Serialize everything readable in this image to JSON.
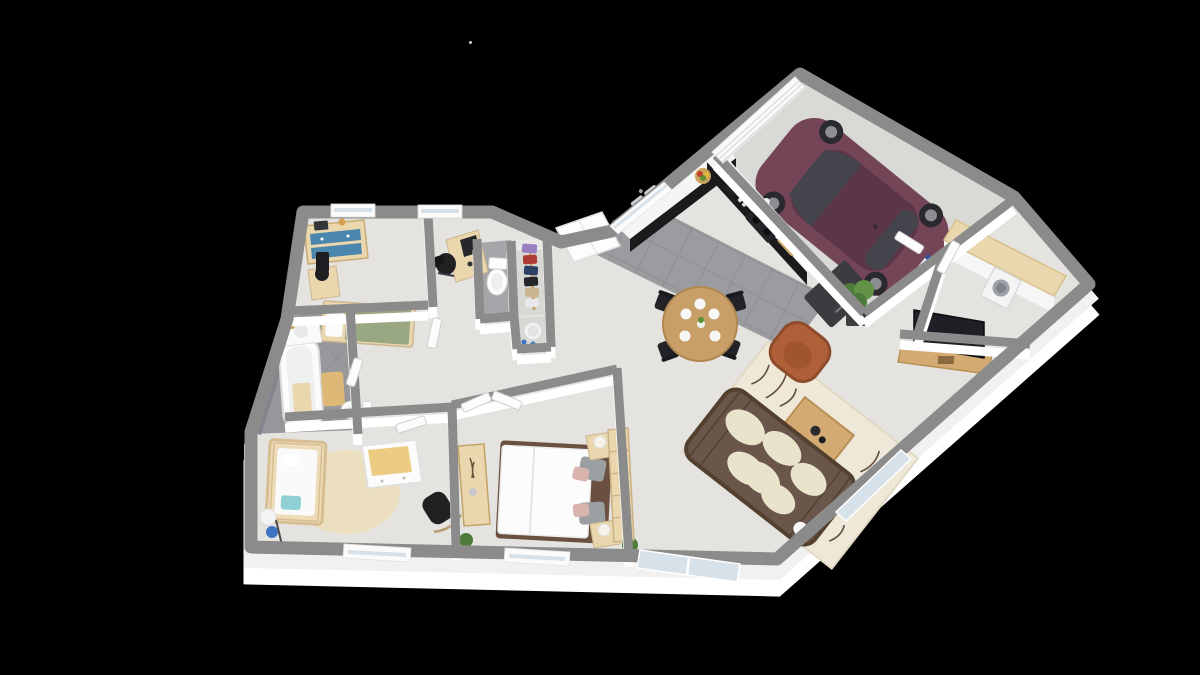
{
  "canvas": {
    "width": 1200,
    "height": 675
  },
  "scene": {
    "description": "Isometric 3D rendered floor plan of a single-storey house with integral garage, shown on a plain black background. No text, toolbars or UI chrome are visible.",
    "view": "top-down isometric render, day wing rotated about 40 degrees versus night wing",
    "artifact_dot": {
      "x": 470,
      "y": 42
    }
  },
  "palette": {
    "bg": "#000000",
    "wall_top": "#8b8b8b",
    "wall_face": "#ffffff",
    "floor": "#e4e3df",
    "floor_garage": "#d9d9d6",
    "floor_tile": "#9c9ca0",
    "grout": "#8b8b8f",
    "floor_bath": "#98989c",
    "floor_wc": "#a6a6aa",
    "floor_hall": "#d8d8d4",
    "glass": "#d7e1ea",
    "frame_white": "#fbfbfb",
    "white": "#fcfcfc",
    "car_body": "#744457",
    "car_roof": "#5a3647",
    "car_glass": "#44444d",
    "counter": "#f5f5f5",
    "cabinet": "#1b1b1e",
    "fridge": "#3a3c40",
    "steel": "#c9ced2",
    "wood": "#d3aa72",
    "wood_pale": "#ead7ae",
    "wood_dark": "#b98f55",
    "table": "#c89f66",
    "sofa": "#6a564a",
    "rattan": "#53402f",
    "cushion": "#eae3cc",
    "armchair": "#b06039",
    "rug": "#efe8d8",
    "rug_ink": "#46331f",
    "black": "#232327",
    "tv": "#1f2026",
    "bed_frame": "#6b4f41",
    "pillow_gray": "#9aa0a2",
    "pillow_pink": "#d9b3ad",
    "sage": "#9aa783",
    "drawer_blue": "#4a86ad",
    "crib": "#eedcb8",
    "teal": "#8fd0d4",
    "mat": "#ddb877",
    "pad_yellow": "#eccc82",
    "plant": "#4e7a3a",
    "plant_light": "#639347",
    "pot": "#3c3e42",
    "washer_door": "#9aa0a6",
    "lamp_blue": "#3f74c4",
    "lamp_yellow": "#e8e29a",
    "clothes_red": "#b03a34",
    "clothes_navy": "#2e3f66",
    "clothes_black": "#23262b",
    "clothes_tan": "#c9b58e",
    "clothes_lilac": "#9a7fc0"
  },
  "rooms": [
    {
      "id": "garage",
      "furniture": [
        "purple-hatchback-car",
        "sectional-garage-door"
      ]
    },
    {
      "id": "kitchen",
      "furniture": [
        "l-shaped-black-cabinets",
        "double-sink",
        "hob",
        "oven",
        "coffee-machine",
        "fruit-bowl",
        "cutting-board",
        "fridge"
      ]
    },
    {
      "id": "dining-area",
      "furniture": [
        "round-wood-table",
        "four-black-metal-chairs",
        "place-settings"
      ]
    },
    {
      "id": "living-room",
      "furniture": [
        "rattan-sofa-cream-cushions",
        "patterned-cream-rug",
        "wood-coffee-table",
        "brown-armchair",
        "tv-on-wood-stand",
        "potted-plants"
      ]
    },
    {
      "id": "laundry-room",
      "furniture": [
        "wood-worktop",
        "washing-machine"
      ]
    },
    {
      "id": "entry-hall",
      "furniture": [
        "white-storage-cupboard"
      ]
    },
    {
      "id": "wc",
      "furniture": [
        "toilet"
      ]
    },
    {
      "id": "walk-in-closet",
      "furniture": [
        "clothes-rack"
      ]
    },
    {
      "id": "storage-nook",
      "furniture": [
        "laundry-basket"
      ]
    },
    {
      "id": "bedroom-2",
      "furniture": [
        "single-bed-sage-bedding",
        "dresser-blue-drawers",
        "desk-with-computer",
        "office-chair",
        "nightstand-black-lamp"
      ]
    },
    {
      "id": "bathroom",
      "furniture": [
        "bathtub",
        "vanity-sink",
        "bath-mat",
        "toilet"
      ]
    },
    {
      "id": "nursery",
      "furniture": [
        "crib",
        "round-cream-rug",
        "changing-dresser",
        "rocking-chair",
        "floor-lamp"
      ]
    },
    {
      "id": "master-bedroom",
      "furniture": [
        "double-bed-white-duvet",
        "two-nightstands-lamps",
        "wood-sideboard",
        "wood-bookcase",
        "plant"
      ]
    }
  ]
}
